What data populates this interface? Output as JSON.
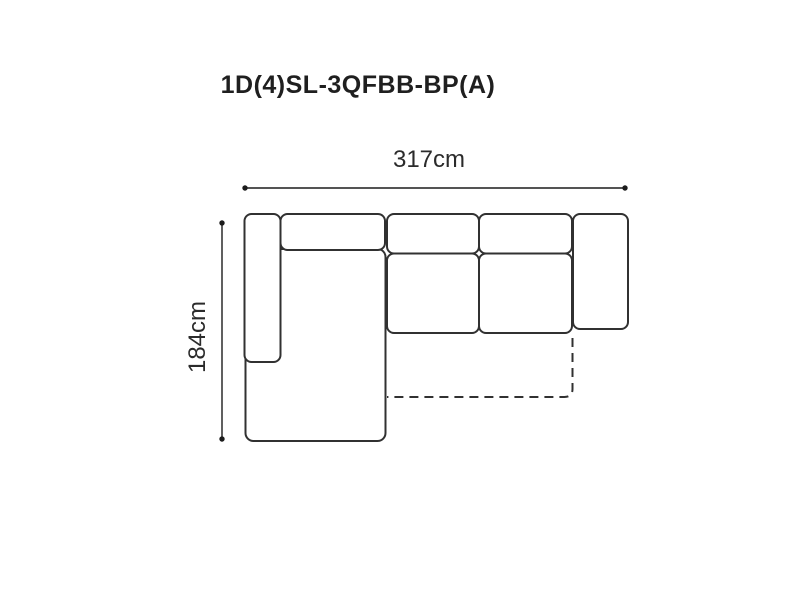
{
  "title": {
    "text": "1D(4)SL-3QFBB-BP(A)"
  },
  "dimensions": {
    "width": {
      "label": "317cm",
      "value_cm": 317,
      "orientation": "horizontal"
    },
    "height": {
      "label": "184cm",
      "value_cm": 184,
      "orientation": "vertical"
    }
  },
  "diagram": {
    "type": "furniture-top-view-line-drawing",
    "description": "Top view schematic of an L-shaped sectional sofa: left armrest, left chaise longue, chaise back cushion, two seat sections with back cushions, right armrest, and a dashed outline indicating the fold-out bed area",
    "parts": [
      "left-armrest",
      "chaise-body",
      "chaise-back-cushion",
      "seat-back-cushion-1",
      "seat-back-cushion-2",
      "seat-cushion-1",
      "seat-cushion-2",
      "right-armrest",
      "fold-out-bed-dashed-outline"
    ]
  },
  "colors": {
    "background": "#ffffff",
    "outline_color": "#313131",
    "dim_color": "#1c1c1c",
    "text_color": "#2b2b2b",
    "title_color": "#1f1f1f"
  }
}
